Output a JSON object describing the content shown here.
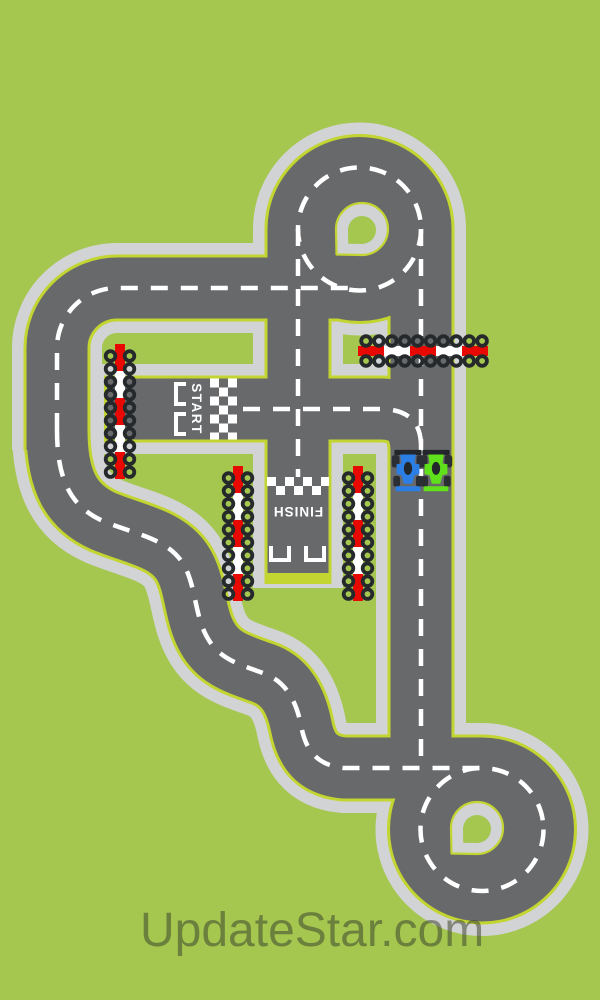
{
  "labels": {
    "start": "START",
    "finish": "FINISH"
  },
  "watermark": {
    "text": "UpdateStar.com"
  },
  "colors": {
    "background": "#a5c750",
    "asphalt": "#68696b",
    "shoulder": "#d2d3d5",
    "edge_line": "#c2d531",
    "center_line": "#ffffff",
    "barrier_red": "#e80a02",
    "barrier_white": "#ffffff",
    "tire": "#26292b",
    "car_blue": "#2b7ee4",
    "car_green": "#5fe01a"
  },
  "cars": [
    {
      "name": "blue-formula-car",
      "color": "#2b7ee4"
    },
    {
      "name": "green-formula-car",
      "color": "#5fe01a"
    }
  ]
}
